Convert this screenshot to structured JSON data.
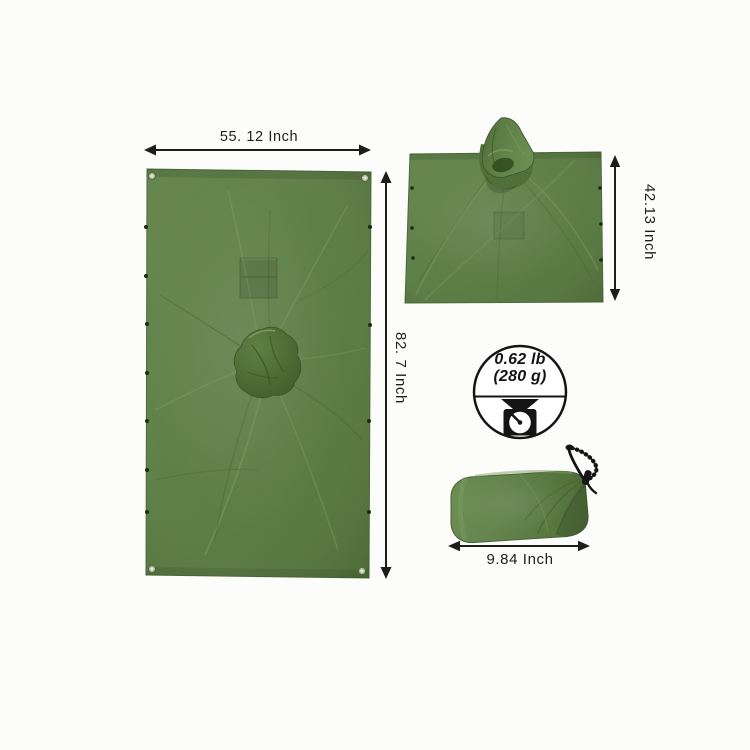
{
  "canvas": {
    "width": 750,
    "height": 750,
    "background": "#fcfcfa"
  },
  "product": {
    "item": "green waterproof poncho / tarp with stuff sack",
    "colors": {
      "fabric_green": "#5b7c44",
      "fabric_green_light": "#6e9054",
      "fabric_green_dark": "#46652f",
      "hood_shadow": "#2f4a1d",
      "cord_black": "#1a1a1a",
      "annotation_black": "#1d1d1d",
      "grommet_ring": "#b9c4a8"
    }
  },
  "measurements": {
    "tarp_width": "55. 12 Inch",
    "tarp_height": "82. 7 Inch",
    "poncho_height": "42.13 Inch",
    "sack_length": "9.84 Inch"
  },
  "weight": {
    "pounds": "0.62 lb",
    "grams": "(280 g)",
    "icon": "kitchen-scale-icon"
  },
  "views": {
    "left": "poncho opened flat as tarp",
    "top_right": "poncho with hood",
    "bottom_right": "packed drawstring stuff sack"
  }
}
